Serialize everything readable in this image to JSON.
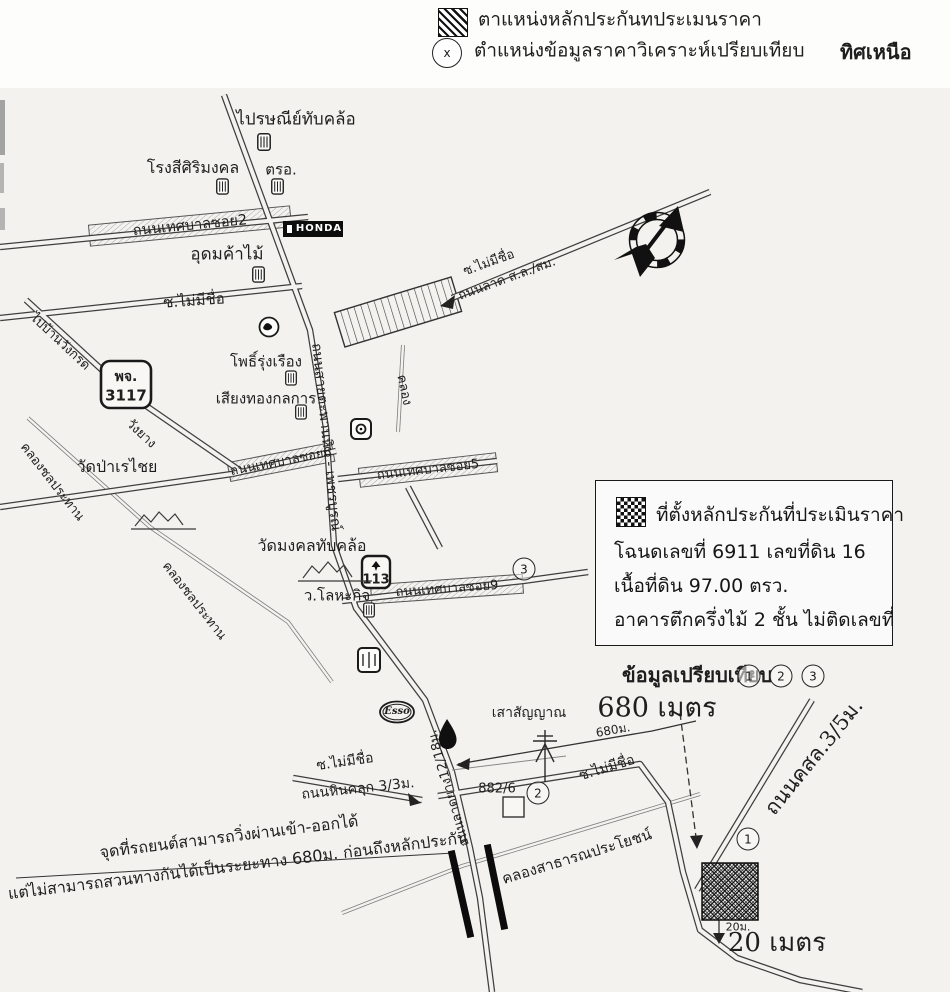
{
  "legend": {
    "subject_label": "ตาแหน่งหลักประกันทประเมนราคา",
    "comparable_label": "ตำแหน่งข้อมูลราคาวิเคราะห์เปรียบเทียบ",
    "comparable_marker": "x",
    "north_label": "ทิศเหนือ"
  },
  "info_box": {
    "title": "ที่ตั้งหลักประกันที่ประเมินราคา",
    "deed_line": "โฉนดเลขที่ 6911 เลขที่ดิน 16",
    "area_line": "เนื้อที่ดิน 97.00 ตรว.",
    "building_line": "อาคารตึกครึ่งไม้ 2 ชั้น ไม่ติดเลขที่"
  },
  "comparison": {
    "label": "ข้อมูลเปรียบเทียบ",
    "markers": [
      "1",
      "2",
      "3"
    ]
  },
  "map": {
    "post_office": "ไปรษณีย์ทับคล้อ",
    "rice_mill": "โรงสีศิริมงคล",
    "inspection": "ตรอ.",
    "road_soi2": "ถนนเทศบาลซอย2",
    "honda": "HONDA",
    "timber_shop": "อุดมค้าไม้",
    "soi_noname_1": "ซ.ไม่มีชื่อ",
    "soi_noname_2": "ซ.ไม่มีชื่อ",
    "road_latsl": "ถนนลาด ส.ล./สม.",
    "pho_rungruang": "โพธิ์รุ่งเรือง",
    "siangthong": "เสียงทองกลการ",
    "sign_phj": "พจ.",
    "sign_phj_no": "3117",
    "wang_yang": "วังยาง",
    "to_ban_wang": "ไปบ้านวังกรด",
    "canal_1": "คลองชลประทาน",
    "canal_2": "คลองชลประทาน",
    "wat_pa": "วัดป่าเรไชย",
    "road_soi6": "ถนนเทศบาลซอย6",
    "road_soi5": "ถนนเทศบาลซอย5",
    "wat_mongkol": "วัดมงคลทับคล้อ",
    "hwy_113": "113",
    "lohakit": "ว.โลหะกิจ",
    "road_soi9": "ถนนเทศบาลซอย9",
    "khlong": "คลอง",
    "main_road": "ถนนสายตะพานหิน - เพชรบูรณ์",
    "esso": "Esso",
    "signal_tower": "เสาสัญญาณ",
    "dist_680_big": "680 เมตร",
    "dist_680_small": "680ม.",
    "soi_noname_3": "ซ.ไม่มีชื่อ",
    "road_hinkhluk": "ถนนหินคลุก 3/3ม.",
    "house_no": "882/6",
    "soi_noname_4": "ซ.ไม่มีชื่อ",
    "public_canal": "คลองสาธารณประโยชน์",
    "road_paved": "ถนนลาดยาง12/18ม.",
    "note_line1": "จุดที่รถยนต์สามารถวิ่งผ่านเข้า-ออกได้",
    "note_line2": "แต่ไม่สามารถสวนทางกันได้เป็นระยะทาง 680ม. ก่อนถึงหลักประกัน",
    "road_csl": "ถนนคสล.3/5ม.",
    "dist_20_small": "20ม.",
    "dist_20_big": "20 เมตร",
    "marker_1": "1",
    "marker_2": "2",
    "marker_3": "3"
  }
}
